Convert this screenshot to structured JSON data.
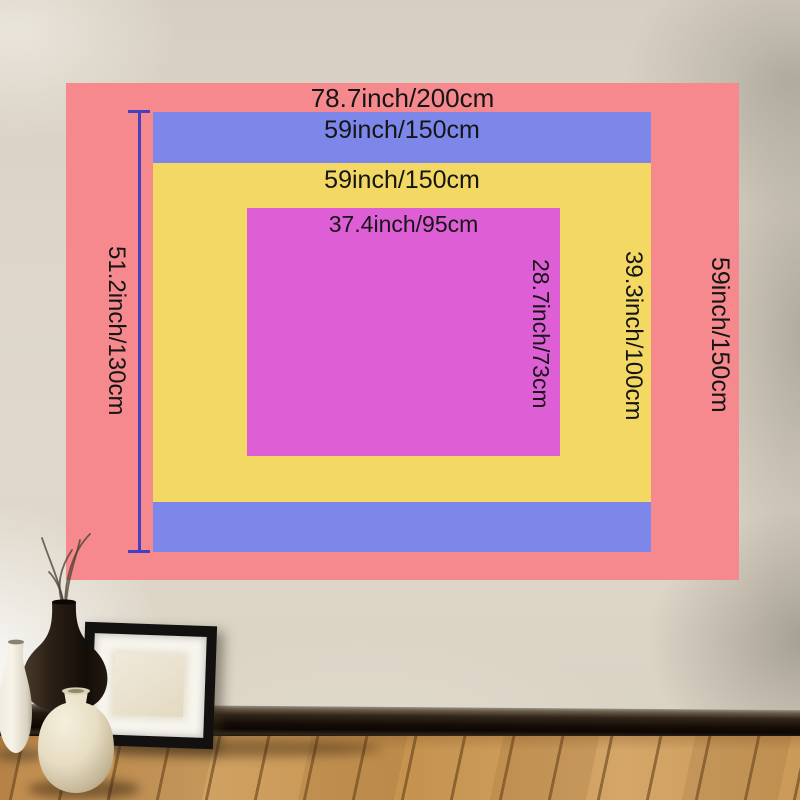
{
  "size_chart": {
    "outer": {
      "top_label": "78.7inch/200cm",
      "right_label": "59inch/150cm",
      "color": "#f6898d"
    },
    "band": {
      "top_label": "59inch/150cm",
      "left_label": "51.2inch/130cm",
      "color": "#7c87e9"
    },
    "middle": {
      "top_label": "59inch/150cm",
      "right_label": "39.3inch/100cm",
      "color": "#f3d964"
    },
    "inner": {
      "top_label": "37.4inch/95cm",
      "right_label": "28.7inch/73cm",
      "color": "#de5ed6"
    }
  },
  "measure_line_color": "#4540c2",
  "text_color": "#151515",
  "scene_colors": {
    "wall": "#dcd5c6",
    "floor_wood": "#c99a58",
    "baseboard": "#1c130b",
    "frame": "#121110",
    "frame_mat": "#f7f5ee"
  }
}
